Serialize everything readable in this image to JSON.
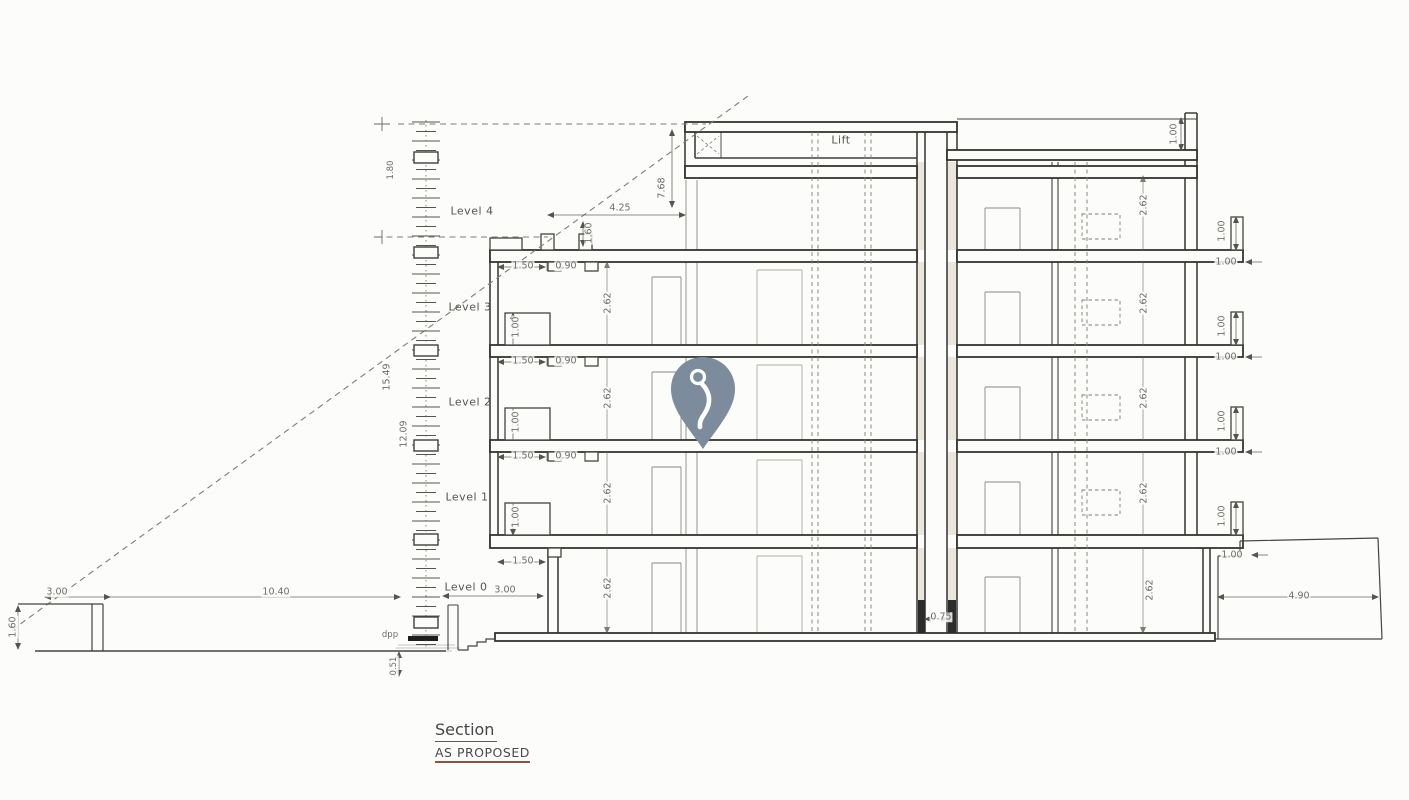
{
  "title_block": {
    "name": "Section",
    "status": "AS PROPOSED"
  },
  "levels": {
    "l4": "Level 4",
    "l3": "Level 3",
    "l2": "Level 2",
    "l1": "Level 1",
    "l0": "Level 0"
  },
  "annotations": {
    "lift": "Lift",
    "dpp": "dpp"
  },
  "dims": {
    "room_height": "2.62",
    "parapet_height": "1.00",
    "balcony_depth": "1.50",
    "door_width": "0.90",
    "roof_setback": "4.25",
    "overrun_height": "7.68",
    "step_height": "1.60",
    "boundary_wall_height": "1.60",
    "front_garden_width": "3.00",
    "site_depth": "10.40",
    "ground_setback": "3.00",
    "foundation_depth": "0.51",
    "lift_pit_width": "0.75",
    "rear_terrace_width": "4.90",
    "total_height": "15.49",
    "upper_height": "12.09",
    "top_height": "1.80"
  },
  "marker": {
    "kind": "location-pin",
    "color": "#7D8C9D"
  },
  "colors": {
    "line": "#3f3f3b",
    "status_underline": "#8D5243"
  }
}
